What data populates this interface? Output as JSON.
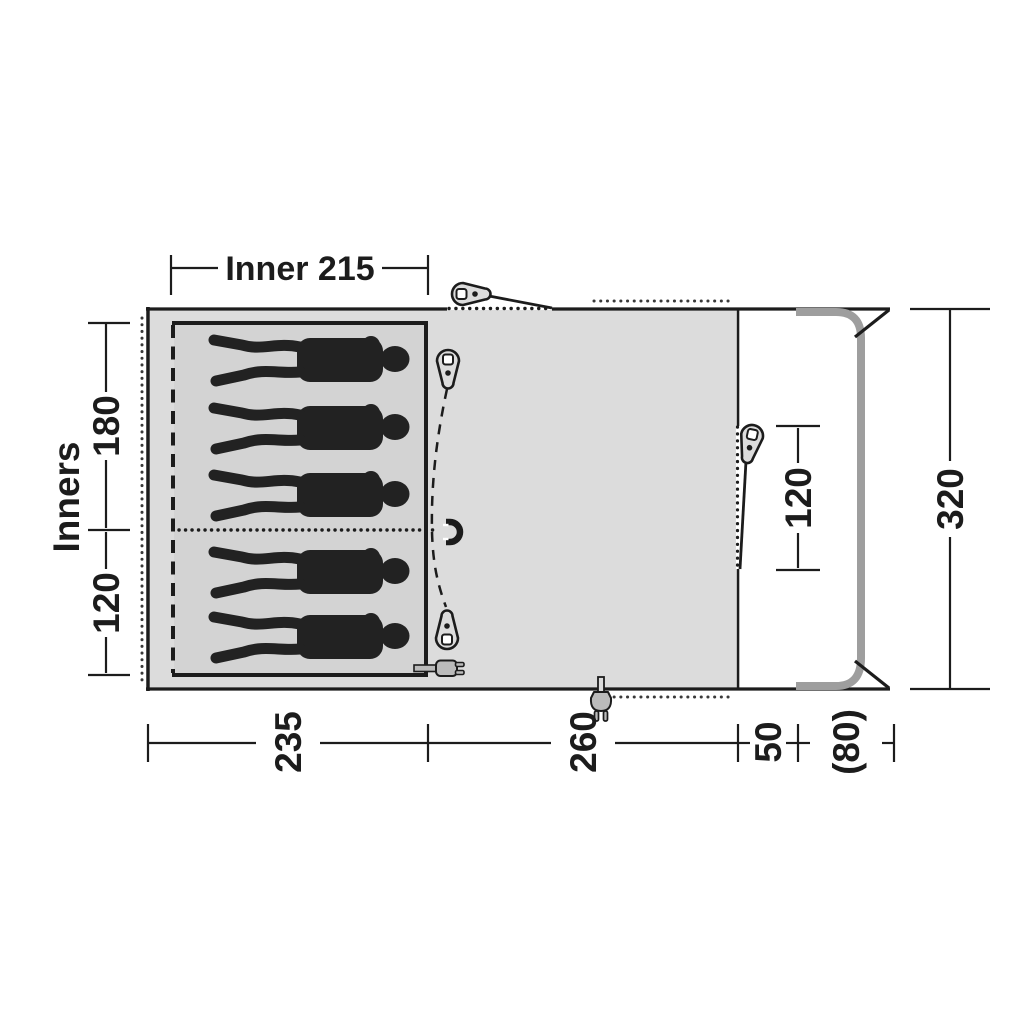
{
  "diagram": {
    "type": "tent-awning-floorplan",
    "labels": {
      "inner_width": "Inner 215",
      "inners": "Inners",
      "inner_depth_a": "180",
      "inner_depth_b": "120",
      "width_bedroom": "235",
      "width_living": "260",
      "width_tunnel": "50",
      "width_connection": "(80)",
      "depth_total": "320",
      "side_door_height": "120"
    },
    "person_count": 5,
    "colors": {
      "background": "#ffffff",
      "floor": "#dcdcdc",
      "inner_floor": "#d3d3d3",
      "line": "#1c1c1c",
      "vehicle_outline": "#9e9e9e",
      "icon_fill": "#bbbbbb",
      "person": "#222222"
    },
    "icons": {
      "zipper_pull": "zipper-pull-icon",
      "magnet": "magnet-icon",
      "power_plug": "power-plug-icon",
      "person": "person-silhouette-icon"
    }
  }
}
